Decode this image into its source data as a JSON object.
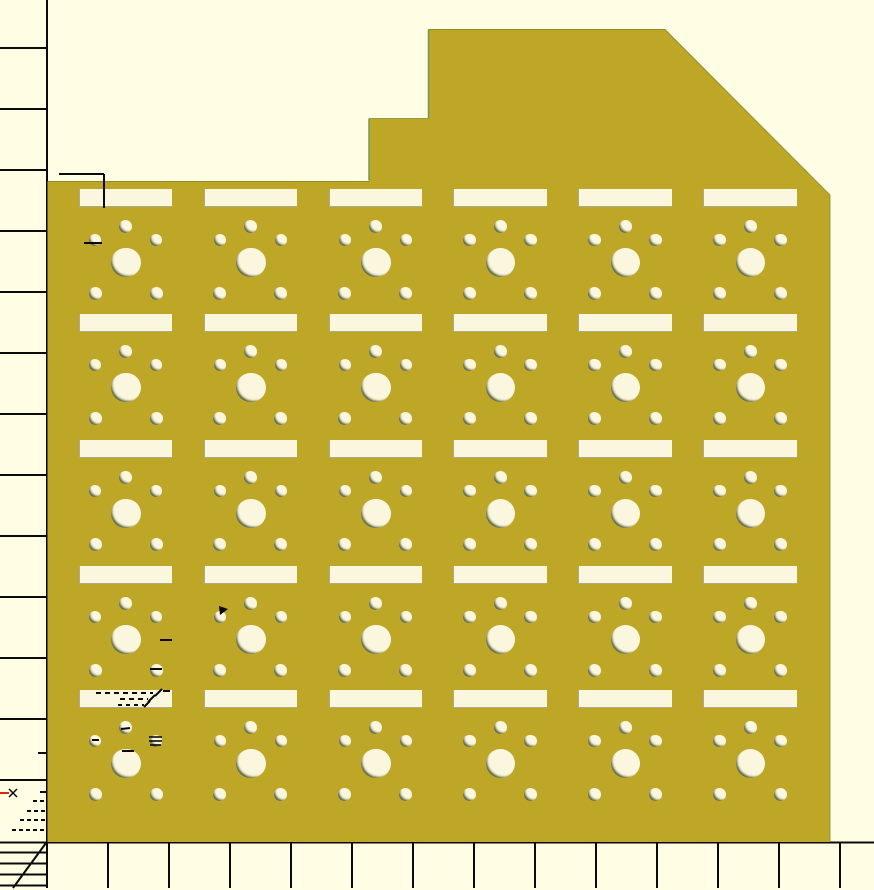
{
  "viewport": {
    "width": 874,
    "height": 890,
    "app_hint": "cad-2d-preview"
  },
  "colors": {
    "background": "#fffee5",
    "plate": "#bea627",
    "hole": "#fbf7de",
    "line": "#0a0a0a",
    "red_mark": "#e02810",
    "edge_outline": "#7d8530",
    "green_edge": "#6d9a55"
  },
  "plate": {
    "outline": [
      [
        47.5,
        181
      ],
      [
        369,
        181
      ],
      [
        369,
        118.5
      ],
      [
        428.5,
        118.5
      ],
      [
        428.5,
        29
      ],
      [
        665,
        29
      ],
      [
        830,
        195
      ],
      [
        830,
        842
      ],
      [
        47.5,
        842
      ]
    ],
    "outline_stroke_points": "47.5,181.5 369,181.5 369,118.5 428.5,118.5 428.5,29.5 665,29.5 830,195 830,841.5",
    "green_edges": [
      {
        "x1": 369,
        "y1": 119,
        "x2": 369,
        "y2": 180
      },
      {
        "x1": 428.5,
        "y1": 30,
        "x2": 428.5,
        "y2": 118
      }
    ]
  },
  "grid": {
    "columns": 6,
    "rows": 5,
    "col_centers": [
      125.5,
      250.4,
      375.3,
      500.2,
      625.1,
      750.0
    ],
    "row_slot_tops": [
      189,
      314,
      440,
      566,
      690
    ],
    "slot_w": 93.5,
    "slot_h": 18,
    "holes": [
      {
        "name": "stabilizer-hole-top",
        "dx": 0,
        "dy": 37.5,
        "d": 13
      },
      {
        "name": "side-hole-left",
        "dx": -30.5,
        "dy": 51,
        "d": 12.5
      },
      {
        "name": "side-hole-right",
        "dx": 30.5,
        "dy": 51,
        "d": 12.5
      },
      {
        "name": "center-switch-hole",
        "dx": 0.5,
        "dy": 73.5,
        "d": 29.5
      },
      {
        "name": "bottom-hole-left",
        "dx": -30.5,
        "dy": 104.5,
        "d": 13
      },
      {
        "name": "bottom-hole-right",
        "dx": 30.5,
        "dy": 104.5,
        "d": 13
      }
    ]
  },
  "rulers": {
    "left_axis": {
      "x": 47,
      "y1": 0,
      "y2": 843
    },
    "bottom_axis": {
      "y": 842.5,
      "x1": 0,
      "x2": 874
    },
    "tick_len_left": 46,
    "bottom_tick_y2": 888,
    "left_ticks_y": [
      48,
      109,
      170,
      231,
      292,
      353,
      414,
      475,
      536,
      597,
      658,
      719,
      780
    ],
    "bottom_ticks_x": [
      47,
      108,
      169,
      230,
      291,
      352,
      413,
      474,
      535,
      596,
      657,
      718,
      779,
      840
    ],
    "ladder_lines_y": [
      852.5,
      863.5,
      874.5,
      885.5
    ],
    "ladder_x2": 46,
    "diagonal": {
      "x1": 46,
      "y1": 843,
      "x2": 13,
      "y2": 888
    }
  },
  "marks": [
    {
      "x1": 59,
      "y1": 174,
      "x2": 104,
      "y2": 174
    },
    {
      "x1": 104,
      "y1": 174,
      "x2": 104,
      "y2": 208
    },
    {
      "x1": 84,
      "y1": 243,
      "x2": 102,
      "y2": 243
    },
    {
      "x1": 160,
      "y1": 640,
      "x2": 172,
      "y2": 640
    },
    {
      "x1": 150,
      "y1": 669,
      "x2": 162,
      "y2": 669
    },
    {
      "x1": 96,
      "y1": 693,
      "x2": 153,
      "y2": 693,
      "dash": "5 4"
    },
    {
      "x1": 155,
      "y1": 696,
      "x2": 162,
      "y2": 689
    },
    {
      "x1": 163,
      "y1": 691,
      "x2": 170,
      "y2": 691
    },
    {
      "x1": 120,
      "y1": 699,
      "x2": 148,
      "y2": 699,
      "dash": "5 4"
    },
    {
      "x1": 148,
      "y1": 702,
      "x2": 155,
      "y2": 695
    },
    {
      "x1": 118,
      "y1": 705,
      "x2": 144,
      "y2": 705,
      "dash": "4 4"
    },
    {
      "x1": 144,
      "y1": 707,
      "x2": 150,
      "y2": 701
    },
    {
      "x1": 121,
      "y1": 729,
      "x2": 130,
      "y2": 728
    },
    {
      "x1": 92,
      "y1": 740,
      "x2": 99,
      "y2": 740
    },
    {
      "x1": 149,
      "y1": 737,
      "x2": 162,
      "y2": 737,
      "w": 1.6
    },
    {
      "x1": 149,
      "y1": 741,
      "x2": 162,
      "y2": 741,
      "w": 1.6
    },
    {
      "x1": 150,
      "y1": 745,
      "x2": 161,
      "y2": 745,
      "w": 1.6
    },
    {
      "x1": 122,
      "y1": 751,
      "x2": 134,
      "y2": 751
    },
    {
      "x1": 38,
      "y1": 753,
      "x2": 46,
      "y2": 753
    },
    {
      "x1": 0,
      "y1": 793,
      "x2": 9,
      "y2": 793,
      "color": "#e02810"
    },
    {
      "x1": 9,
      "y1": 789,
      "x2": 17,
      "y2": 797,
      "w": 1.5
    },
    {
      "x1": 17,
      "y1": 789,
      "x2": 9,
      "y2": 797,
      "w": 1.5
    },
    {
      "x1": 40,
      "y1": 792,
      "x2": 46,
      "y2": 792
    },
    {
      "x1": 33,
      "y1": 801,
      "x2": 46,
      "y2": 801,
      "dash": "4 3"
    },
    {
      "x1": 27,
      "y1": 811,
      "x2": 46,
      "y2": 811,
      "dash": "4 3"
    },
    {
      "x1": 20,
      "y1": 820,
      "x2": 46,
      "y2": 820,
      "dash": "4 3"
    },
    {
      "x1": 12,
      "y1": 830,
      "x2": 46,
      "y2": 830,
      "dash": "4 3"
    }
  ],
  "triangle_mark": {
    "points": "219,606 228,609 220,615"
  }
}
